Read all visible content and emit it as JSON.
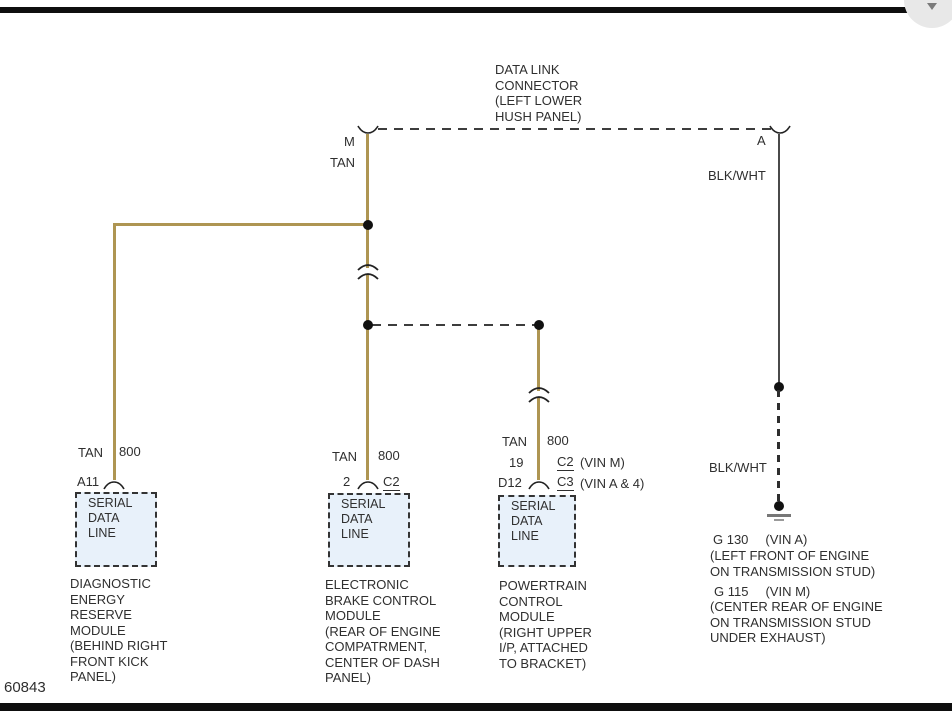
{
  "page": {
    "ref_number": "60843"
  },
  "dlc": {
    "label": "DATA LINK\nCONNECTOR\n(LEFT LOWER\nHUSH PANEL)",
    "pin_left": "M",
    "pin_right": "A"
  },
  "wire_labels": {
    "tan_top": "TAN",
    "blkwht_top": "BLK/WHT",
    "blkwht_bottom": "BLK/WHT"
  },
  "colors": {
    "tan_wire": "#ae9552",
    "module_box_fill": "#e8f1fa"
  },
  "modules": {
    "derm": {
      "wire": "TAN",
      "circuit": "800",
      "pin": "A11",
      "box": "SERIAL\nDATA\nLINE",
      "name": "DIAGNOSTIC\nENERGY\nRESERVE\nMODULE\n(BEHIND RIGHT\nFRONT KICK\nPANEL)"
    },
    "ebcm": {
      "wire": "TAN",
      "circuit": "800",
      "pin": "2",
      "connector": "C2",
      "box": "SERIAL\nDATA\nLINE",
      "name": "ELECTRONIC\nBRAKE CONTROL\nMODULE\n(REAR OF ENGINE\nCOMPATRMENT,\nCENTER OF DASH\nPANEL)"
    },
    "pcm": {
      "wire": "TAN",
      "circuit": "800",
      "pin_row1": {
        "pin": "19",
        "connector": "C2",
        "note": "(VIN M)"
      },
      "pin_row2": {
        "pin": "D12",
        "connector": "C3",
        "note": "(VIN A & 4)"
      },
      "box": "SERIAL\nDATA\nLINE",
      "name": "POWERTRAIN\nCONTROL\nMODULE\n(RIGHT UPPER\nI/P, ATTACHED\nTO BRACKET)"
    }
  },
  "ground": {
    "g1_id": "G 130",
    "g1_vin": "(VIN A)",
    "g1_loc": "(LEFT FRONT OF ENGINE\nON TRANSMISSION STUD)",
    "g2_id": "G 115",
    "g2_vin": "(VIN M)",
    "g2_loc": "(CENTER REAR OF ENGINE\nON TRANSMISSION STUD\nUNDER EXHAUST)"
  }
}
